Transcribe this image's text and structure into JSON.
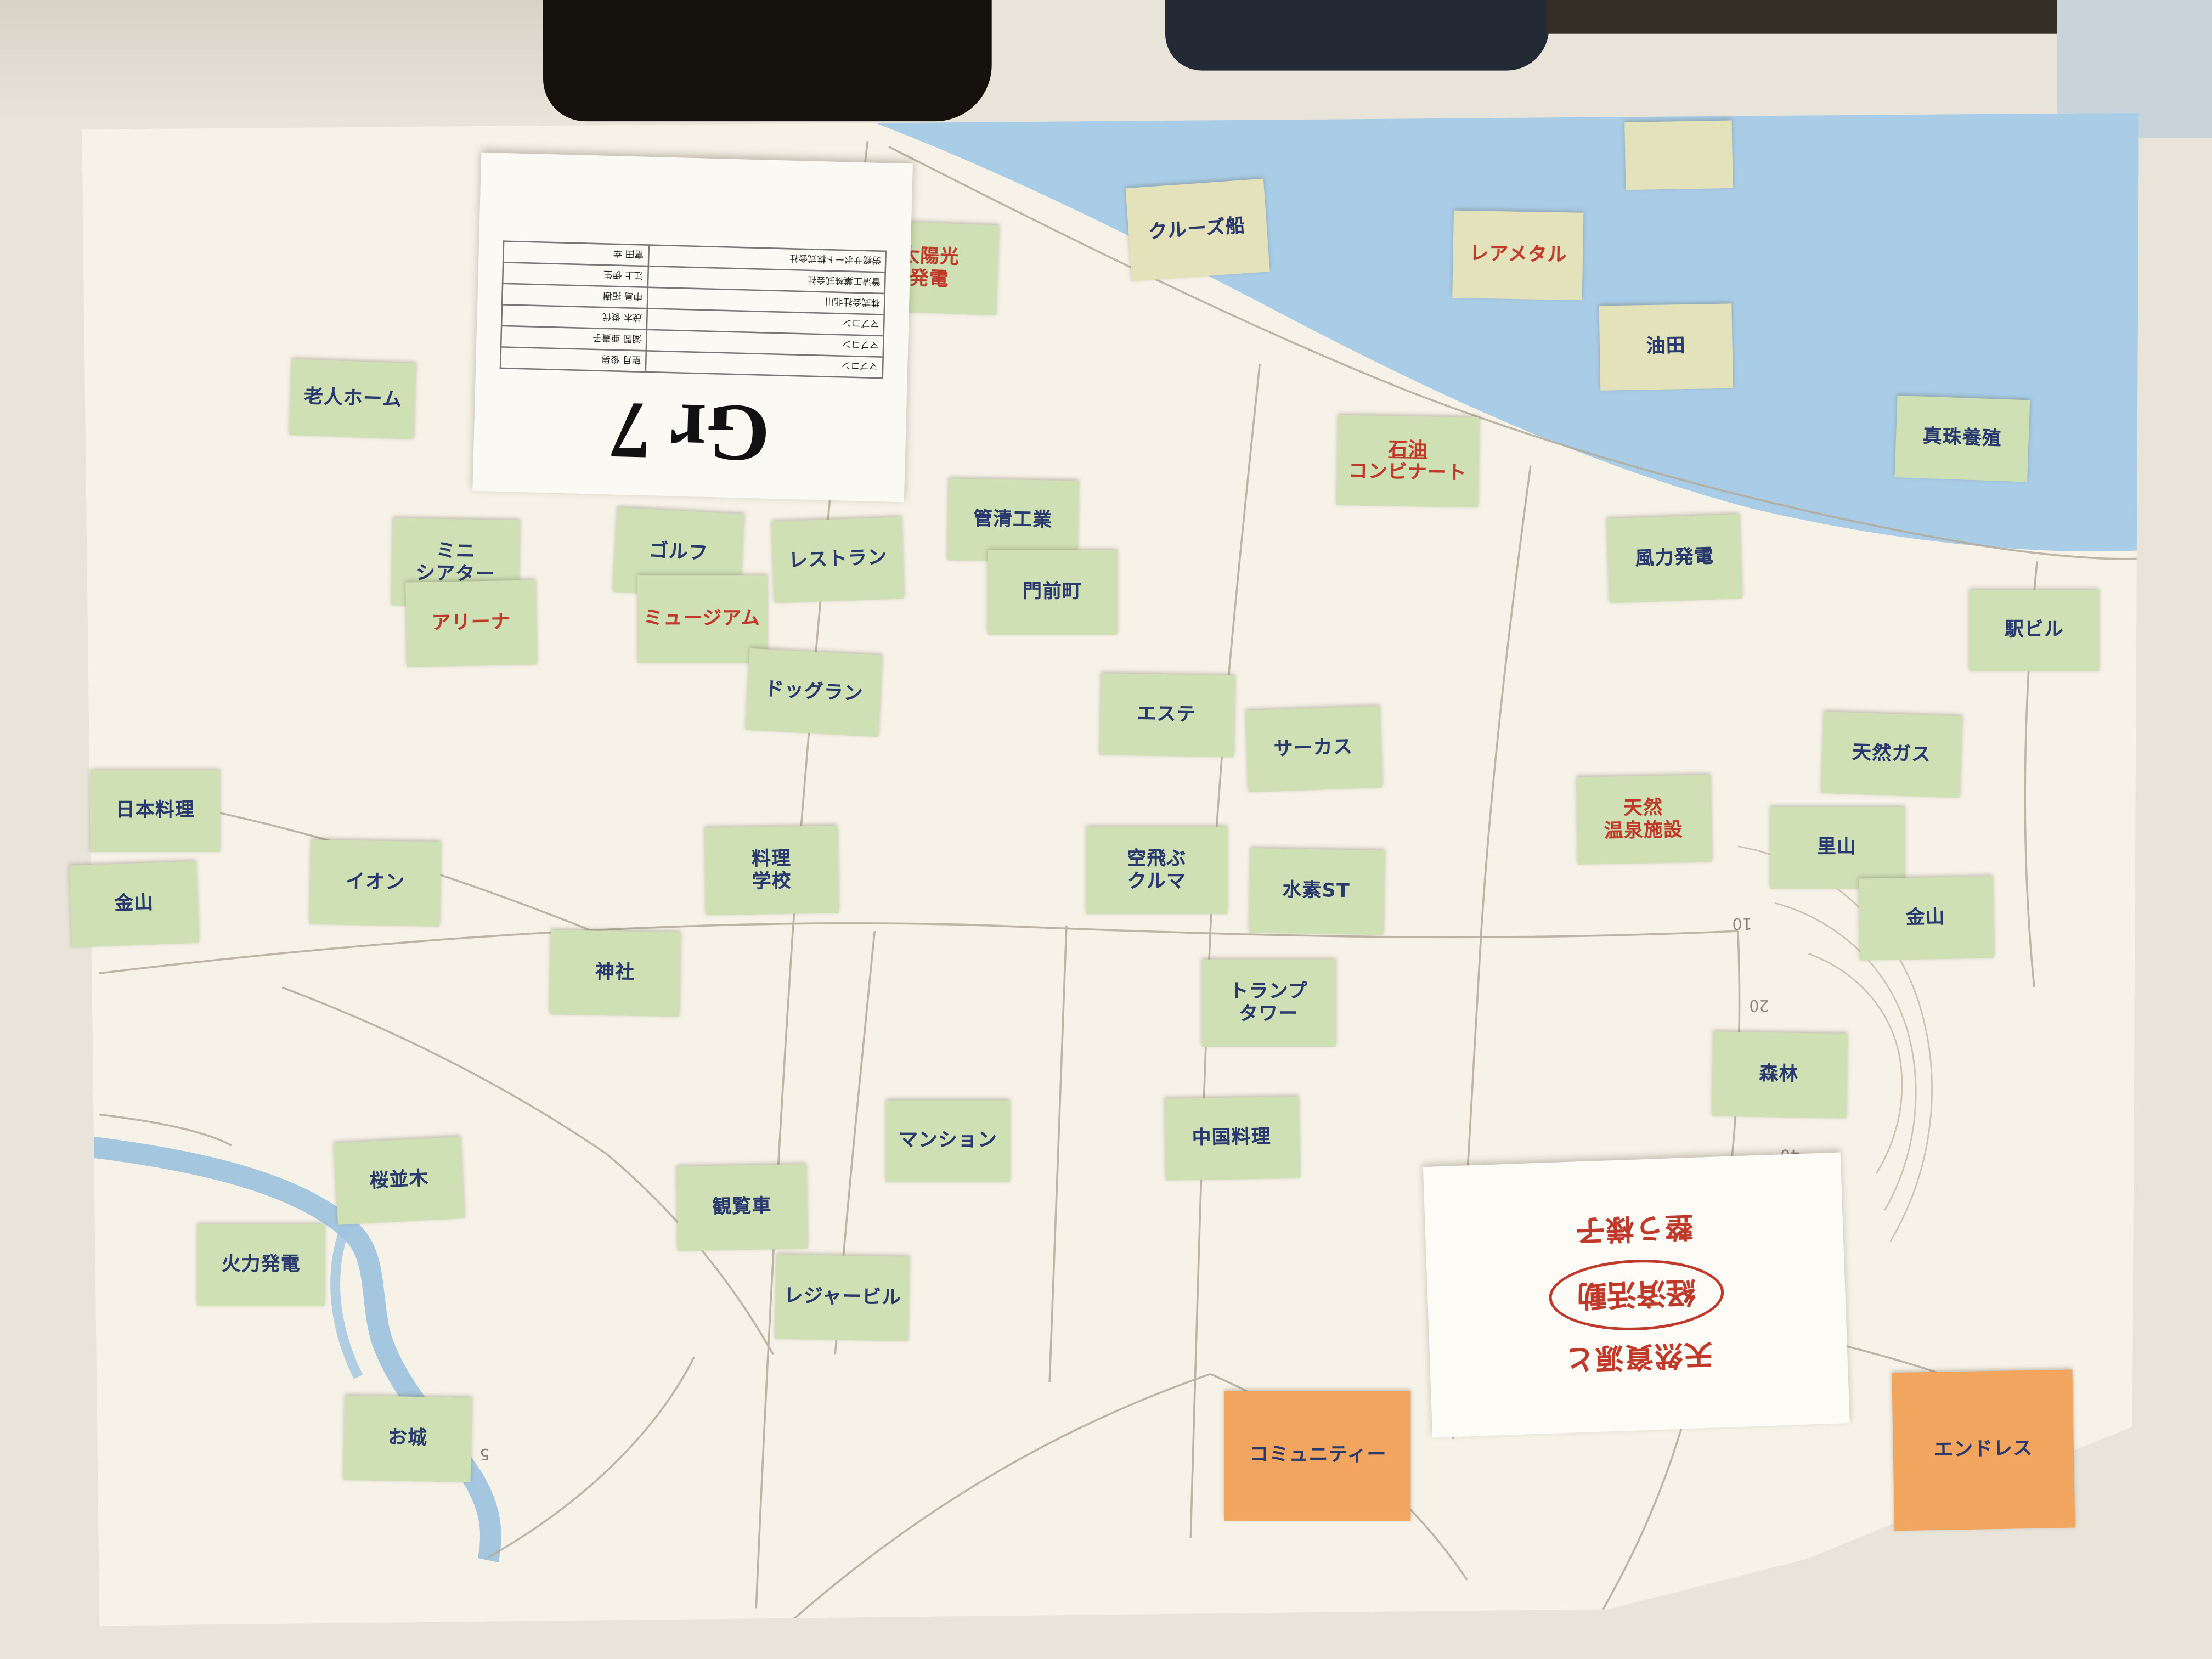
{
  "group_sign": {
    "title": "Gr 7",
    "members": [
      {
        "company": "マブコン",
        "name": "望月 俊男"
      },
      {
        "company": "マブコン",
        "name": "湖間 亜貴子"
      },
      {
        "company": "マブコン",
        "name": "茂木 俊代"
      },
      {
        "company": "株式会社北川",
        "name": "中島 拓樹"
      },
      {
        "company": "管清工業株式会社",
        "name": "江上 伊生"
      },
      {
        "company": "労務サポート株式会社",
        "name": "富田 幸"
      }
    ]
  },
  "vision_card": {
    "line1": "天然資源と",
    "circled": "経済活動",
    "line2": "整う様子"
  },
  "map": {
    "contour_labels": [
      "10",
      "20",
      "30",
      "40",
      "5"
    ],
    "colors": {
      "sea": "#a9cde7",
      "river": "#9fc3de",
      "paper": "#f6f2e8",
      "note_green": "#cfe0b4",
      "note_cream": "#e4e2ba",
      "note_orange": "#f2a55e",
      "ink_blue": "#2b3a6e",
      "ink_red": "#c03a2b"
    }
  },
  "sticky_notes": [
    {
      "lines": [
        "老人ホーム"
      ],
      "color": "green",
      "ink": "blue"
    },
    {
      "lines": [
        "特区"
      ],
      "color": "green",
      "ink": "red"
    },
    {
      "lines": [
        "ミニ",
        "シアター"
      ],
      "color": "green",
      "ink": "blue"
    },
    {
      "lines": [
        "アリーナ"
      ],
      "color": "green",
      "ink": "red"
    },
    {
      "lines": [
        "ゴルフ"
      ],
      "color": "green",
      "ink": "blue"
    },
    {
      "lines": [
        "ミュージアム"
      ],
      "color": "green",
      "ink": "red"
    },
    {
      "lines": [
        "レストラン"
      ],
      "color": "green",
      "ink": "blue"
    },
    {
      "lines": [
        "管清工業"
      ],
      "color": "green",
      "ink": "blue"
    },
    {
      "lines": [
        "門前町"
      ],
      "color": "green",
      "ink": "blue"
    },
    {
      "lines": [
        "太陽光",
        "発電"
      ],
      "color": "green",
      "ink": "red"
    },
    {
      "lines": [
        "クルーズ船"
      ],
      "color": "cream",
      "ink": "blue"
    },
    {
      "lines": [
        "レアメタル"
      ],
      "color": "cream",
      "ink": "red"
    },
    {
      "lines": [
        "油田"
      ],
      "color": "cream",
      "ink": "blue"
    },
    {
      "lines": [
        "石油",
        "コンビナート"
      ],
      "color": "green",
      "ink": "red",
      "underline_first": true
    },
    {
      "lines": [
        "風力発電"
      ],
      "color": "green",
      "ink": "blue"
    },
    {
      "lines": [
        "真珠養殖"
      ],
      "color": "green",
      "ink": "blue"
    },
    {
      "lines": [
        "駅ビル"
      ],
      "color": "green",
      "ink": "blue"
    },
    {
      "lines": [
        "エステ"
      ],
      "color": "green",
      "ink": "blue"
    },
    {
      "lines": [
        "サーカス"
      ],
      "color": "green",
      "ink": "blue"
    },
    {
      "lines": [
        "空飛ぶ",
        "クルマ"
      ],
      "color": "green",
      "ink": "blue",
      "small_first": true
    },
    {
      "lines": [
        "水素ST"
      ],
      "color": "green",
      "ink": "blue"
    },
    {
      "lines": [
        "天然",
        "温泉施設"
      ],
      "color": "green",
      "ink": "red",
      "small_first": true
    },
    {
      "lines": [
        "天然ガス"
      ],
      "color": "green",
      "ink": "blue"
    },
    {
      "lines": [
        "里山"
      ],
      "color": "green",
      "ink": "blue"
    },
    {
      "lines": [
        "金山"
      ],
      "color": "green",
      "ink": "blue"
    },
    {
      "lines": [
        "森林"
      ],
      "color": "green",
      "ink": "blue"
    },
    {
      "lines": [
        "トランプ",
        "タワー"
      ],
      "color": "green",
      "ink": "blue"
    },
    {
      "lines": [
        "中国料理"
      ],
      "color": "green",
      "ink": "blue"
    },
    {
      "lines": [
        "ドッグラン"
      ],
      "color": "green",
      "ink": "blue"
    },
    {
      "lines": [
        "日本料理"
      ],
      "color": "green",
      "ink": "blue"
    },
    {
      "lines": [
        "金山"
      ],
      "color": "green",
      "ink": "blue"
    },
    {
      "lines": [
        "イオン"
      ],
      "color": "green",
      "ink": "blue"
    },
    {
      "lines": [
        "料理",
        "学校"
      ],
      "color": "green",
      "ink": "blue"
    },
    {
      "lines": [
        "神社"
      ],
      "color": "green",
      "ink": "blue"
    },
    {
      "lines": [
        "桜並木"
      ],
      "color": "green",
      "ink": "blue"
    },
    {
      "lines": [
        "火力発電"
      ],
      "color": "green",
      "ink": "blue"
    },
    {
      "lines": [
        "お城"
      ],
      "color": "green",
      "ink": "blue"
    },
    {
      "lines": [
        "観覧車"
      ],
      "color": "green",
      "ink": "blue"
    },
    {
      "lines": [
        "レジャービル"
      ],
      "color": "green",
      "ink": "blue"
    },
    {
      "lines": [
        "マンション"
      ],
      "color": "green",
      "ink": "blue"
    },
    {
      "lines": [
        ""
      ],
      "color": "cream",
      "ink": "blue"
    },
    {
      "lines": [
        "コミュニティー"
      ],
      "color": "orange",
      "ink": "blue"
    },
    {
      "lines": [
        "エンドレス"
      ],
      "color": "orange",
      "ink": "blue"
    }
  ]
}
